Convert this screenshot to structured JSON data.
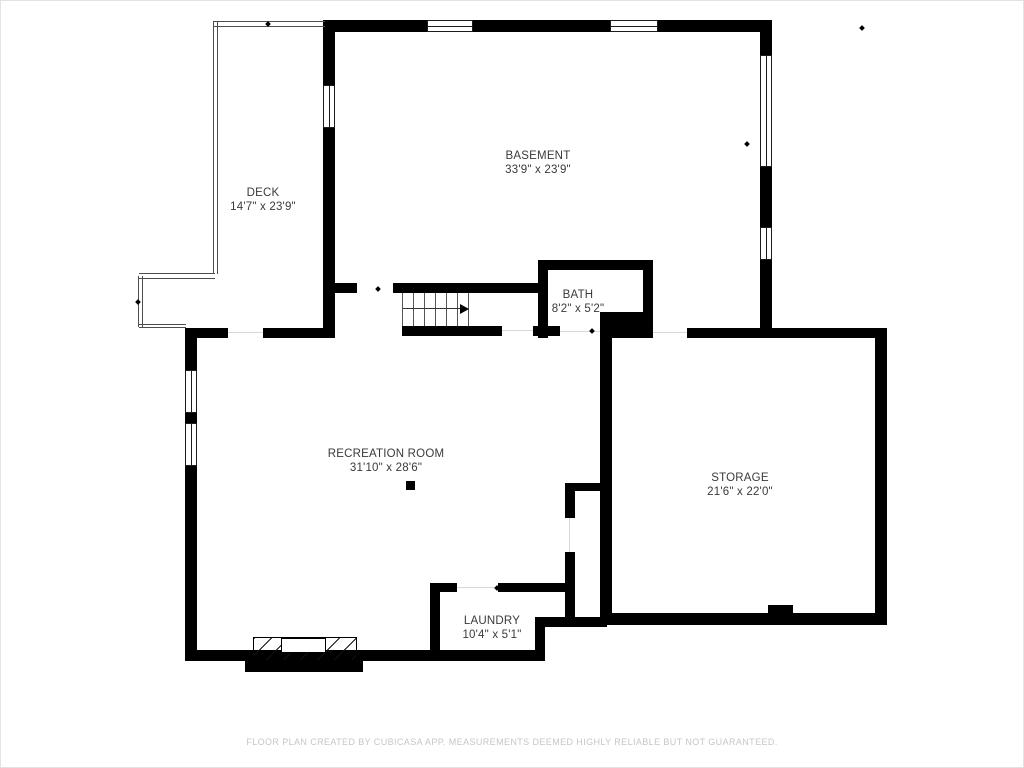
{
  "rooms": {
    "deck": {
      "name": "DECK",
      "dims": "14'7\" x 23'9\""
    },
    "basement": {
      "name": "BASEMENT",
      "dims": "33'9\" x 23'9\""
    },
    "bath": {
      "name": "BATH",
      "dims": "8'2\" x 5'2\""
    },
    "recreation": {
      "name": "RECREATION ROOM",
      "dims": "31'10\" x 28'6\""
    },
    "storage": {
      "name": "STORAGE",
      "dims": "21'6\" x 22'0\""
    },
    "laundry": {
      "name": "LAUNDRY",
      "dims": "10'4\" x 5'1\""
    }
  },
  "footer": {
    "text": "FLOOR PLAN CREATED BY CUBICASA APP. MEASUREMENTS DEEMED HIGHLY RELIABLE BUT NOT GUARANTEED."
  },
  "colors": {
    "wall": "#000000",
    "background": "#ffffff",
    "room_label": "#3a3a3a",
    "footer_text": "#c6c6c6"
  }
}
